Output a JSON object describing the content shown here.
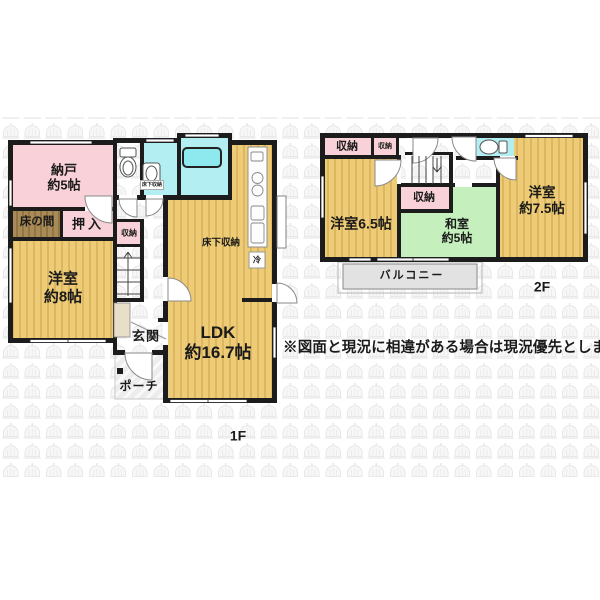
{
  "disclaimer": "※図面と現況に相違がある場合は現況優先とします",
  "floor1": {
    "floor_label": "1F",
    "rooms": {
      "nando": {
        "name": "納戸",
        "size": "約5帖"
      },
      "tokonoma": {
        "name": "床の間"
      },
      "oshiire": {
        "name": "押入"
      },
      "hall_closet": {
        "name": "収納"
      },
      "bedroom8": {
        "name": "洋室",
        "size": "約8帖"
      },
      "entrance": {
        "name": "玄関"
      },
      "porch": {
        "name": "ポーチ"
      },
      "ldk": {
        "name": "LDK",
        "size": "約16.7帖"
      },
      "underfloor_storage": {
        "name": "床下収納"
      },
      "underfloor_storage_small": {
        "name": "床下収納"
      },
      "refrigerator": {
        "name": "冷"
      }
    }
  },
  "floor2": {
    "floor_label": "2F",
    "rooms": {
      "closet_left": {
        "name": "収納"
      },
      "closet_left_small": {
        "name": "収納"
      },
      "bedroom65": {
        "name": "洋室6.5帖"
      },
      "closet_mid": {
        "name": "収納"
      },
      "washitsu": {
        "name": "和室",
        "size": "約5帖"
      },
      "bedroom75": {
        "name": "洋室",
        "size": "約7.5帖"
      },
      "balcony": {
        "name": "バルコニー"
      }
    }
  },
  "colors": {
    "wall": "#1c1c1c",
    "western_room_tan": "#eecb76",
    "closet_pink": "#f8d2d8",
    "tatami_green": "#c5f0bd",
    "wet_area_cyan": "#b2eef2",
    "tokonoma_brown": "#a98a59"
  }
}
